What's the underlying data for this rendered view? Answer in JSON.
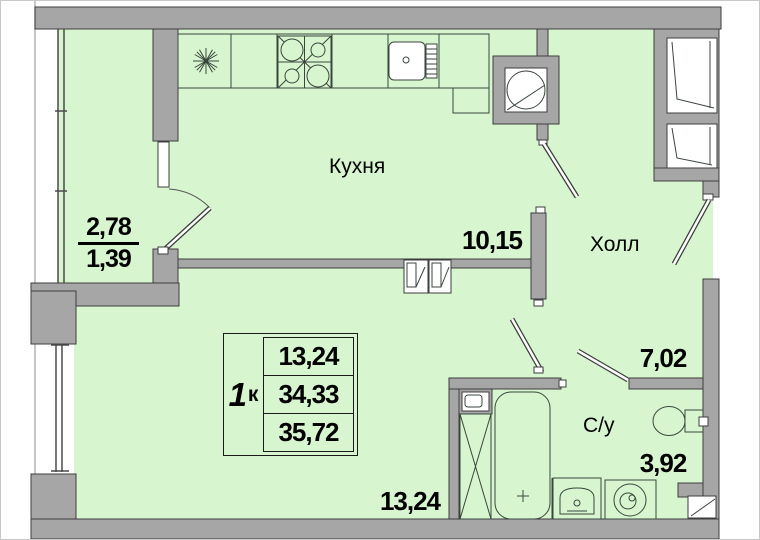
{
  "plan": {
    "kind": "apartment-floor-plan",
    "rooms": {
      "kitchen": {
        "label": "Кухня",
        "area": "10,15"
      },
      "hall": {
        "label": "Холл",
        "area": "7,02"
      },
      "bathroom": {
        "label": "С/у",
        "area": "3,92"
      },
      "living_room": {
        "area": "13,24"
      },
      "balcony": {
        "area_total": "2,78",
        "area_coef": "1,39"
      }
    },
    "summary_table": {
      "rooms_count": "1",
      "rooms_unit": "к",
      "living_area": "13,24",
      "area_without_balcony": "34,33",
      "total_area": "35,72"
    },
    "colors": {
      "floor": "#d7f5cf",
      "wall_fill": "#a6a6a6",
      "wall_stroke": "#3d3d3d",
      "fixture": "#3a463c",
      "text": "#000000"
    }
  }
}
